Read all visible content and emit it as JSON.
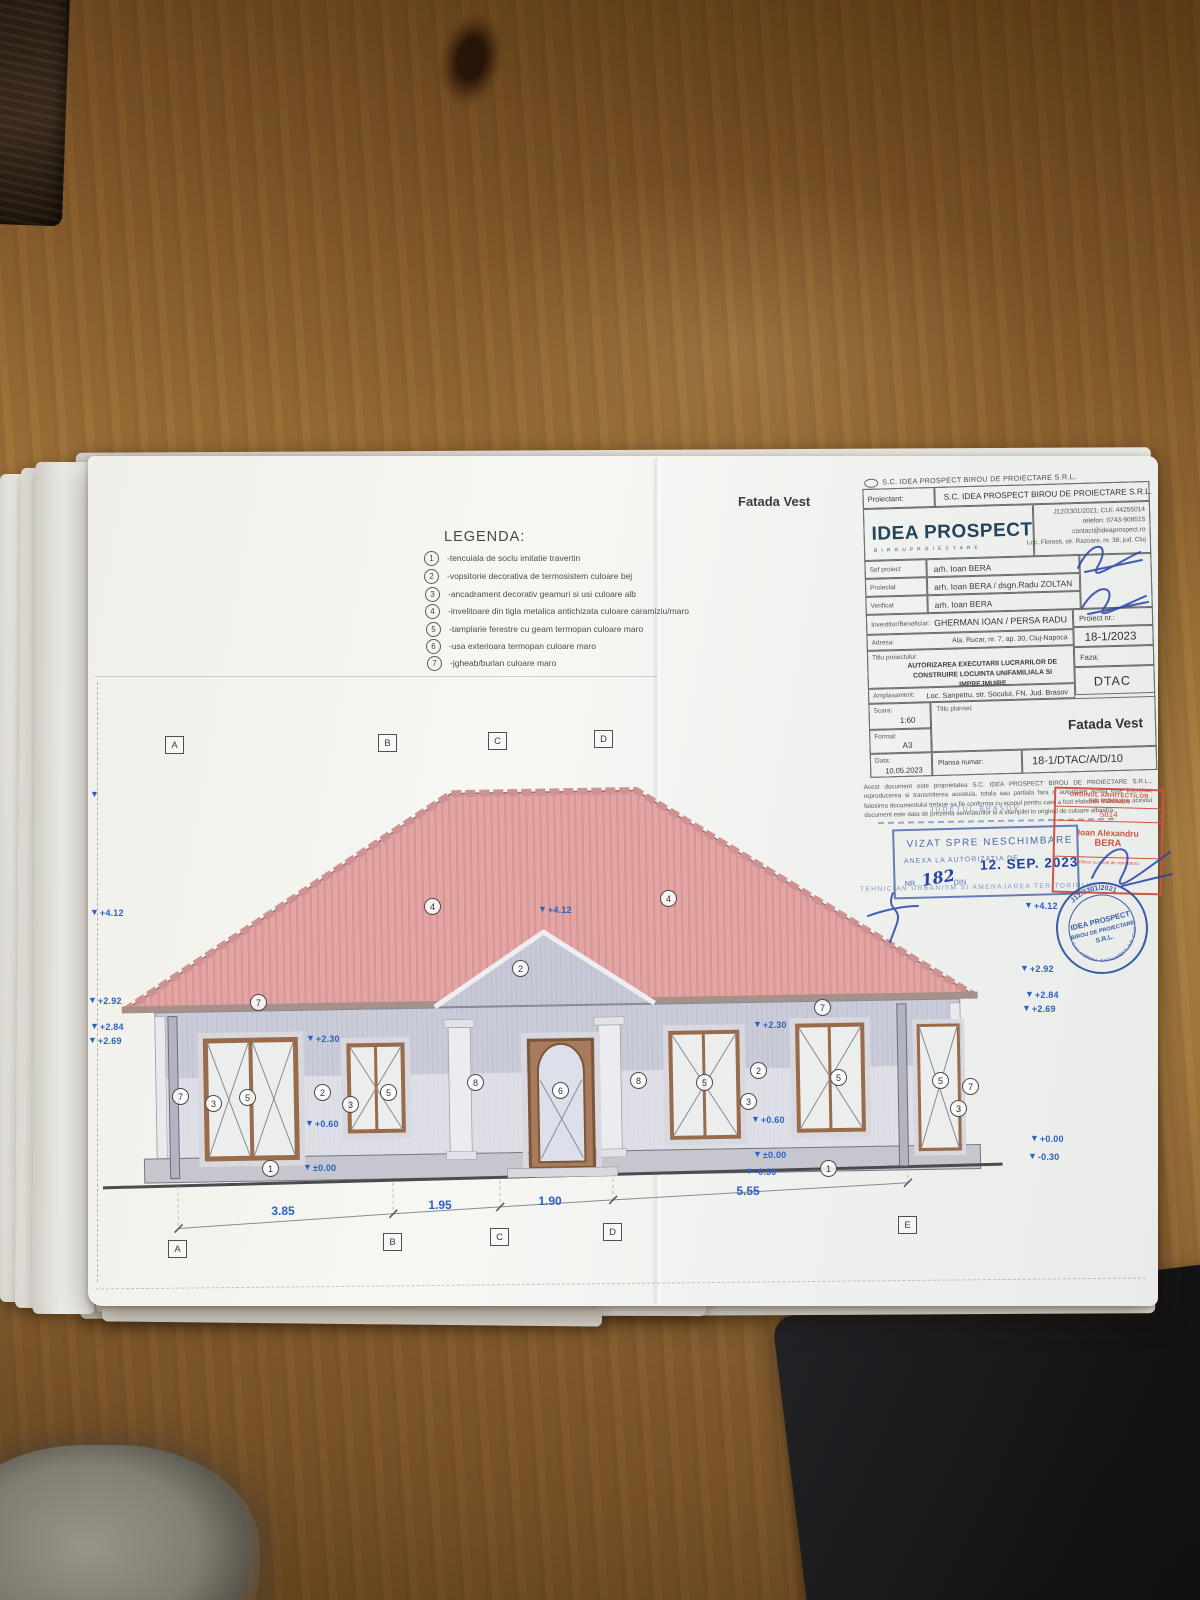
{
  "colors": {
    "roof_pink": "#e3a5a3",
    "wall_gray": "#cbccd9",
    "marker_blue": "#2b62c4",
    "stamp_blue": "#2b4fa0",
    "stamp_red": "#cf5340",
    "logo_navy": "#24435c"
  },
  "sheet": {
    "facade_title": "Fatada Vest",
    "legend": {
      "title": "LEGENDA:",
      "items": [
        {
          "num": "1",
          "text": "-tencuiala de soclu imitatie travertin"
        },
        {
          "num": "2",
          "text": "-vopsitorie decorativa de termosistem culoare bej"
        },
        {
          "num": "3",
          "text": "-ancadrament decorativ geamuri si usi culoare alb"
        },
        {
          "num": "4",
          "text": "-invelitoare din tigla metalica antichizata culoare caramiziu/maro"
        },
        {
          "num": "5",
          "text": "-tamplarie ferestre cu geam termopan culoare maro"
        },
        {
          "num": "6",
          "text": "-usa exterioara termopan culoare maro"
        },
        {
          "num": "7",
          "text": "-jgheab/burlan culoare maro"
        }
      ]
    },
    "title_block": {
      "top_company": "S.C. IDEA PROSPECT BIROU DE PROIECTARE S.R.L.",
      "proiectant_label": "Proiectant:",
      "proiectant_value": "S.C. IDEA PROSPECT BIROU DE PROIECTARE S.R.L.",
      "logo_main": "IDEA PROSPECT",
      "logo_sub": "B I R O U   P R O I E C T A R E",
      "reg_lines": [
        "J12/2301/2021; CUI: 44255014",
        "telefon: 0743-908515",
        "contact@ideaprospect.ro",
        "Loc. Floresti, str. Razoare, nr. 38, jud. Cluj"
      ],
      "rows": [
        {
          "label": "Sef proiect",
          "value": "arh. Ioan BERA"
        },
        {
          "label": "Proiectat",
          "value": "arh. Ioan BERA / dsgn.Radu ZOLTAN"
        },
        {
          "label": "Verificat",
          "value": "arh. Ioan BERA"
        }
      ],
      "investitor_label": "Investitor/Beneficiar:",
      "investitor_value": "GHERMAN IOAN / PERSA RADU",
      "adresa_label": "Adresa:",
      "adresa_value": "Ala. Rucar, nr. 7, ap. 30, Cluj-Napoca",
      "proiect_nr_label": "Proiect nr.:",
      "proiect_nr_value": "18-1/2023",
      "titlu_label": "Titlu proiectului:",
      "titlu_value": "AUTORIZAREA EXECUTARII LUCRARILOR DE CONSTRUIRE LOCUINTA UNIFAMILIALA SI IMPREJMUIRE",
      "faza_label": "Faza:",
      "faza_value": "DTAC",
      "amplasament_label": "Amplasament:",
      "amplasament_value": "Loc. Sanpetru, str. Socului, FN, Jud. Brasov",
      "scara_label": "Scara:",
      "scara_value": "1:60",
      "titlu_plansei_label": "Titlu plansei:",
      "titlu_plansei_value": "Fatada Vest",
      "format_label": "Format:",
      "format_value": "A3",
      "data_label": "Data:",
      "data_value": "10.05.2023",
      "plansa_label": "Plansa numar:",
      "plansa_value": "18-1/DTAC/A/D/10",
      "disclaimer": "Acest document este proprietatea S.C. IDEA PROSPECT BIROU DE PROIECTARE S.R.L.; reproducerea si transmiterea acestuia, totala sau partiala fara o autorizare scrisa este interzisa; folosirea documentului trebuie sa fie conforma cu scopul pentru care a fost elaborat. Validitatea acestui document este data de prezenta semnaturilor si a stampilei in original de culoare albastra."
    },
    "stamps": {
      "judet": "JUDETUL BRASOV",
      "vizat": "VIZAT SPRE NESCHIMBARE",
      "anexa": "ANEXA LA AUTORIZATIA DE",
      "nr_label": "NR.",
      "nr_value": "182",
      "din_label": "DIN",
      "date": "12. SEP. 2023",
      "tehnician": "TEHNICIAN URBANISM SI AMENAJAREA TERITORIULUI",
      "oar_line1": "ORDINUL ARHITECTILOR",
      "oar_line2": "DIN ROMANIA",
      "oar_nr": "5814",
      "oar_first": "Ioan Alexandru",
      "oar_last": "BERA",
      "oar_sub": "Arhitect cu drept de semnatura",
      "round_top": "J12/2301/2021",
      "round_l1": "IDEA PROSPECT",
      "round_l2": "BIROU DE PROIECTARE",
      "round_l3": "S.R.L.",
      "round_bottom": "C.U.I. 44255014 · SAT FLORESTI, JUD. CLUJ"
    },
    "drawing": {
      "axes_top": [
        "A",
        "B",
        "C",
        "D"
      ],
      "axes_bottom": [
        "A",
        "B",
        "C",
        "D",
        "E"
      ],
      "dimensions": [
        "3.85",
        "1.95",
        "1.90",
        "5.55"
      ],
      "elevations": {
        "ridge": "+4.12",
        "eave_high": "+2.92",
        "eave_mid": "+2.84",
        "eave_low": "+2.69",
        "lintel": "+2.30",
        "sill": "+0.60",
        "zero": "+0.00",
        "zero_pm": "±0.00",
        "ground": "-0.30"
      },
      "callouts": [
        "1",
        "2",
        "3",
        "4",
        "5",
        "6",
        "7",
        "8"
      ]
    }
  }
}
